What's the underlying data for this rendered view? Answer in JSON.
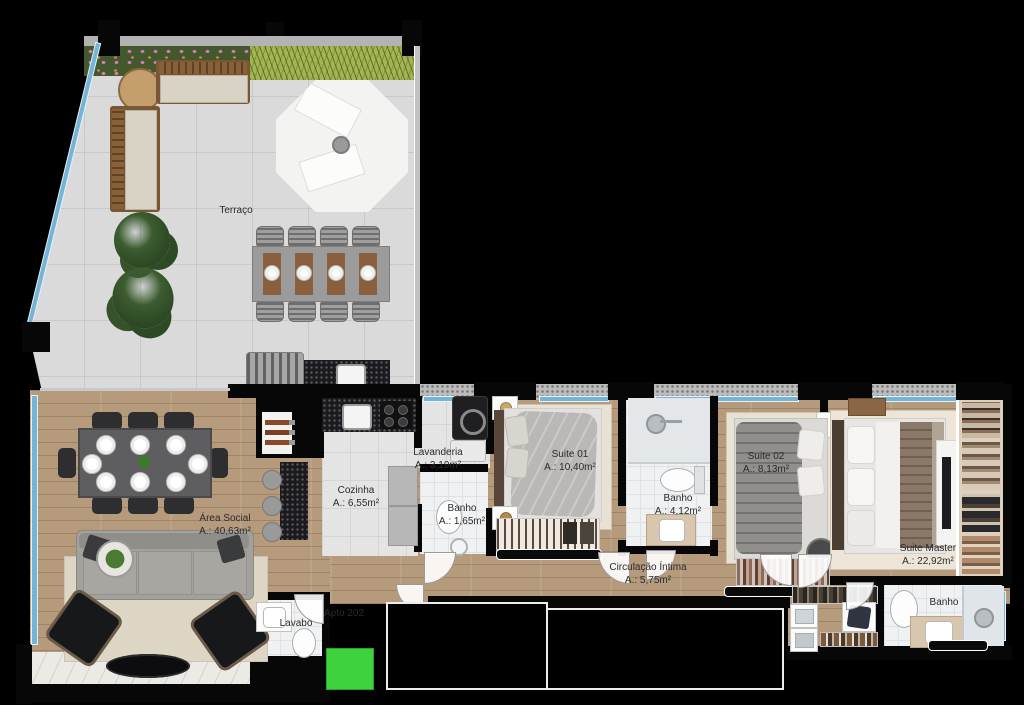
{
  "title": "Planta do apartamento",
  "unit": {
    "label": "Apto 202"
  },
  "rooms": {
    "terraco": {
      "name": "Terraço",
      "area": ""
    },
    "area_social": {
      "name": "Área Social",
      "area": "A.: 40,63m²"
    },
    "cozinha": {
      "name": "Cozinha",
      "area": "A.: 6,55m²"
    },
    "lavanderia": {
      "name": "Lavanderia",
      "area": "A.: 3,19m²"
    },
    "banho_servico": {
      "name": "Banho",
      "area": "A.: 1,65m²"
    },
    "suite_01": {
      "name": "Suite 01",
      "area": "A.: 10,40m²"
    },
    "banho_suites": {
      "name": "Banho",
      "area": "A.: 4,12m²"
    },
    "suite_02": {
      "name": "Suite 02",
      "area": "A.: 8,13m²"
    },
    "suite_master": {
      "name": "Suite Master",
      "area": "A.: 22,92m²"
    },
    "banho_master": {
      "name": "Banho",
      "area": ""
    },
    "circulacao_intima": {
      "name": "Circulação Íntima",
      "area": "A.: 5,75m²"
    },
    "lavabo": {
      "name": "Lavabo",
      "area": ""
    }
  },
  "colors": {
    "background": "#000000",
    "highlight_green": "#3fd23f",
    "glass_blue": "#74b4d6",
    "wood_floor": "#b59a7c",
    "terrace_tile": "#dadada",
    "granite": "#1b1b1f",
    "marble": "#eceae5"
  }
}
